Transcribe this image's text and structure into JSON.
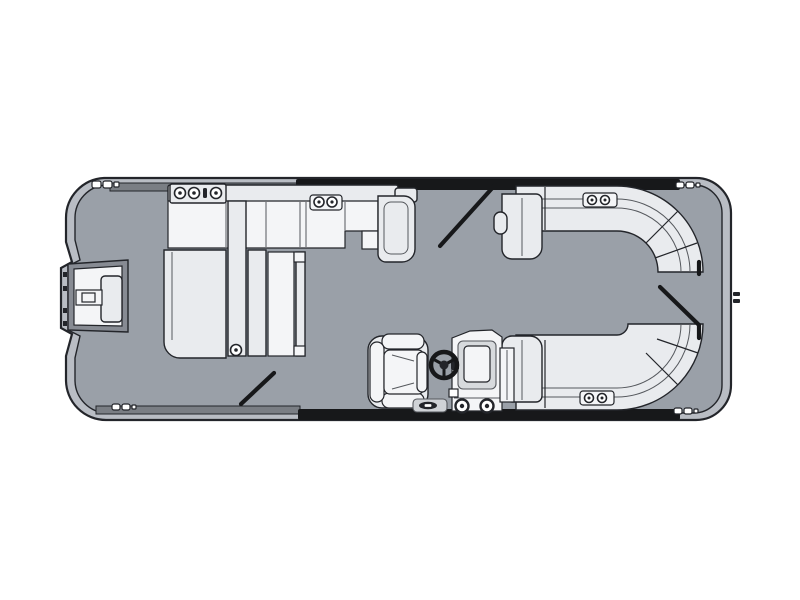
{
  "page": {
    "background": "#ffffff"
  },
  "diagram": {
    "type": "pontoon-boat-floorplan-top-view",
    "title": "Pontoon boat floor plan (overhead view)",
    "colors": {
      "background": "#ffffff",
      "deck": "#9aa0a8",
      "hull_band": "#b9bdc4",
      "furniture": "#e9ebee",
      "furniture_light": "#f4f5f7",
      "outline_dark": "#23252a",
      "outline_mid": "#55585d",
      "rail_black": "#17181a",
      "rail_gray": "#7a7e84"
    },
    "components": {
      "hull": "Hull outline with rub-rail band",
      "deck": "Gray deck surface",
      "bow_platform": "Bow boarding platform with gate",
      "bow_ladder": "Bow boarding ladder",
      "fwd_couch": "Port forward lounge couch",
      "cupholder_armrest": "Forward armrest with cup holders",
      "fwd_speaker": "Forward speaker / cup holder panel",
      "chaise": "Port chaise lounger",
      "aft_bench": "Port aft-facing bench with flip back",
      "port_gate_fwd": "Port forward boarding gate (open)",
      "port_gate_aft": "Port aft boarding gate (open)",
      "stern_gate": "Stern boarding gate (open)",
      "bench_top_right": "Starboard bow wraparound L-bench",
      "bench_bottom_right": "Starboard stern wraparound L-bench",
      "stern_speaker_top": "Stern speaker panel (top bench)",
      "stern_speaker_bottom": "Stern speaker panel (bottom bench)",
      "captains_chair": "Captain's helm chair",
      "helm_console": "Helm console with windscreen",
      "steering_wheel": "Steering wheel",
      "boarding_step": "Helm-side step pad",
      "cleats": "Mooring cleats",
      "transom_fitting": "Starboard rail fitting",
      "top_rail": "Port side fence rail",
      "bottom_rail": "Starboard side fence rail"
    }
  }
}
